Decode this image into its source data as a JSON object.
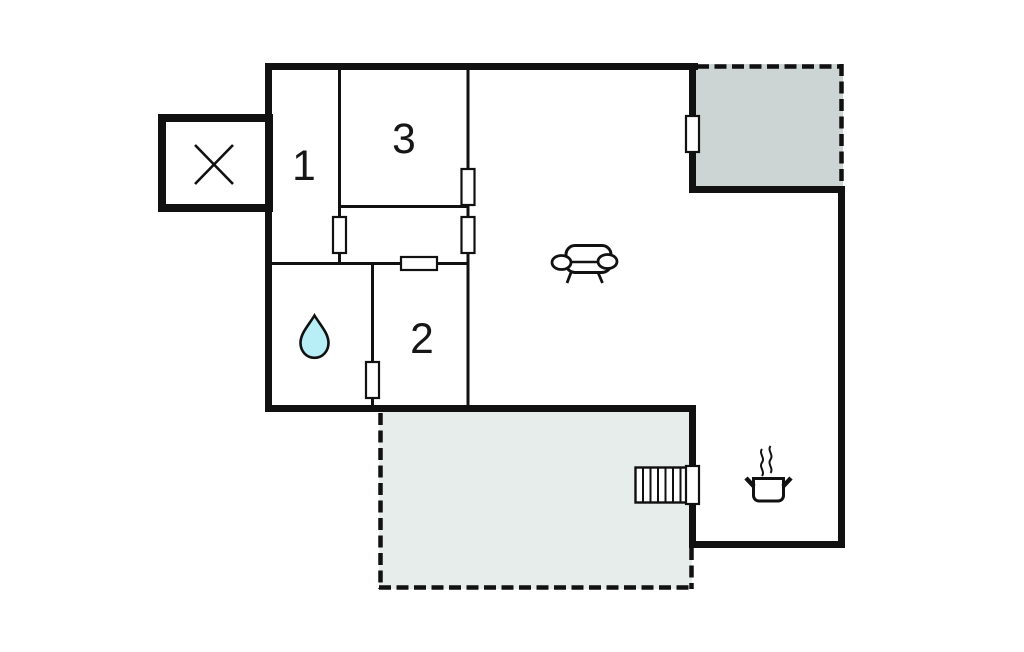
{
  "plan": {
    "rooms": [
      {
        "id": "room-1",
        "label": "1"
      },
      {
        "id": "room-2",
        "label": "2"
      },
      {
        "id": "room-3",
        "label": "3"
      }
    ],
    "icons": {
      "annex": "x-marker-icon",
      "bathroom": "water-drop-icon",
      "living_room": "sofa-icon",
      "kitchen": "cooking-pot-icon",
      "terrace_access": "stairs-icon"
    },
    "colors": {
      "background": "#ffffff",
      "wall": "#111111",
      "terrace_shaded": "#ccd5d4",
      "terrace_light": "#e7edeb",
      "water_drop_fill": "#b8eef6"
    }
  }
}
